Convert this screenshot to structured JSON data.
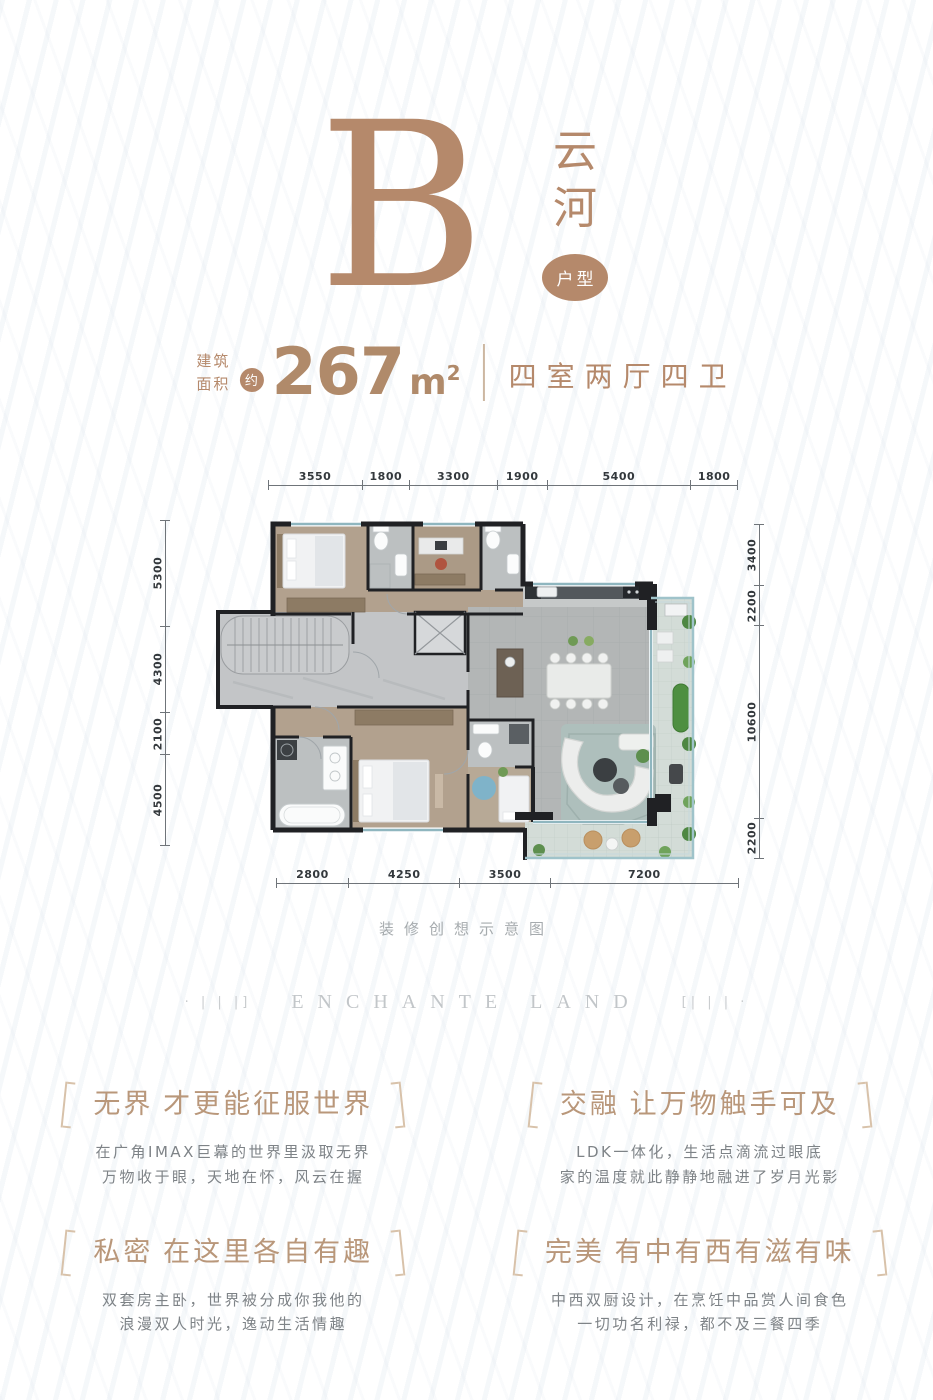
{
  "accent": "#b5896b",
  "header": {
    "letter": "B",
    "name_top": "云",
    "name_bottom": "河",
    "badge": "户型"
  },
  "area": {
    "label_top": "建筑",
    "label_bottom": "面积",
    "approx": "约",
    "value": "267",
    "unit": "m",
    "unit_sup": "2",
    "rooms": "四室两厅四卫"
  },
  "plan": {
    "caption": "装修创想示意图",
    "dims": {
      "top": [
        3550,
        1800,
        3300,
        1900,
        5400,
        1800
      ],
      "bottom": [
        2800,
        4250,
        3500,
        7200
      ],
      "left": [
        5300,
        4300,
        2100,
        4500
      ],
      "right": [
        3400,
        2200,
        10600,
        2200
      ]
    }
  },
  "brand": {
    "left_marks": "· | | |]",
    "text": "ENCHANTE LAND",
    "right_marks": "[| | | ·"
  },
  "features": [
    {
      "heading": "无界 才更能征服世界",
      "line1": "在广角IMAX巨幕的世界里汲取无界",
      "line2": "万物收于眼，天地在怀，风云在握"
    },
    {
      "heading": "交融 让万物触手可及",
      "line1": "LDK一体化，生活点滴流过眼底",
      "line2": "家的温度就此静静地融进了岁月光影"
    },
    {
      "heading": "私密 在这里各自有趣",
      "line1": "双套房主卧，世界被分成你我他的",
      "line2": "浪漫双人时光，逸动生活情趣"
    },
    {
      "heading": "完美 有中有西有滋有味",
      "line1": "中西双厨设计，在烹饪中品赏人间食色",
      "line2": "一切功名利禄，都不及三餐四季"
    }
  ]
}
